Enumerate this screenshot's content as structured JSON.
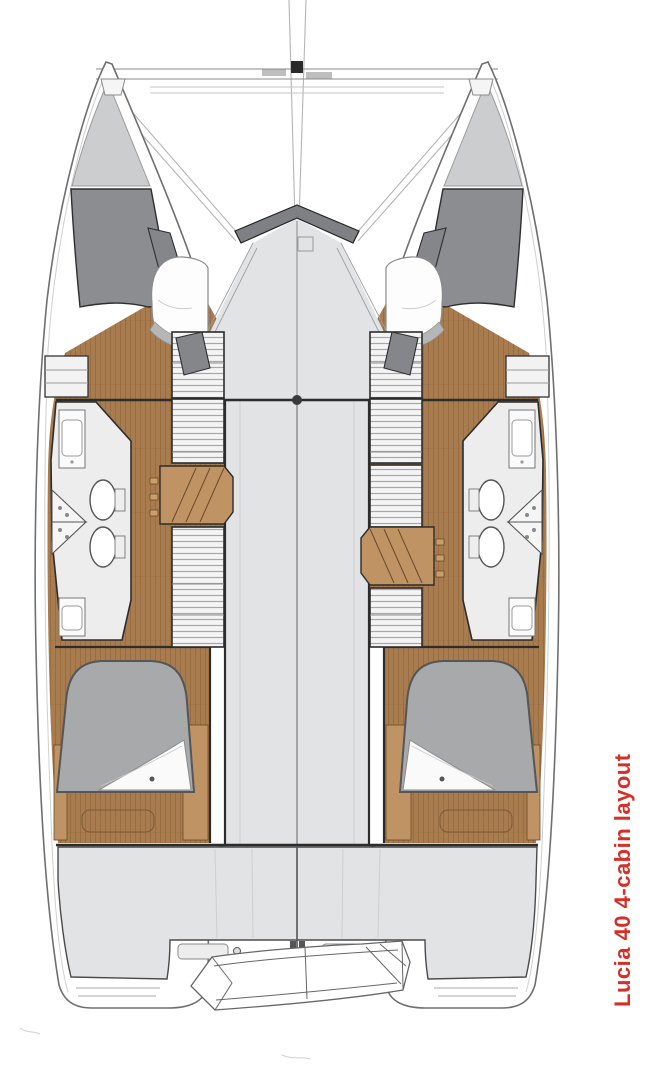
{
  "annotation": {
    "label": "Lucia 40 4-cabin layout"
  },
  "boat": {
    "model": "Lucia 40",
    "layout_type": "4-cabin layout",
    "view": "deck floor plan, top-down",
    "areas": [
      "bow-crossbeam",
      "trampoline",
      "port-bow-locker",
      "starboard-bow-locker",
      "port-forward-cabin",
      "starboard-forward-cabin",
      "port-bathroom",
      "starboard-bathroom",
      "port-companionway-steps",
      "starboard-companionway-steps",
      "saloon-bridgedeck",
      "port-aft-cabin",
      "starboard-aft-cabin",
      "cockpit",
      "port-swim-platform",
      "starboard-swim-platform",
      "tender-dinghy"
    ]
  },
  "colors": {
    "background": "#ffffff",
    "deck_gray": "#e2e3e5",
    "bow_locker_light": "#cbcdcf",
    "locker_dark": "#8b8d90",
    "chevron_dark": "#7e8083",
    "wood": "#a87c4e",
    "wood_plank_line": "#8a6036",
    "wood_light": "#bf9364",
    "bed_gray": "#a7a9ab",
    "linen_white": "#fafafa",
    "bath_floor": "#ededee",
    "hatch_fill": "#f4f4f4",
    "hatch_line": "#a8a8a8",
    "outline_dark": "#2c2c2c",
    "hull_line": "#6f6f6f",
    "accent_red": "#d52f28"
  }
}
